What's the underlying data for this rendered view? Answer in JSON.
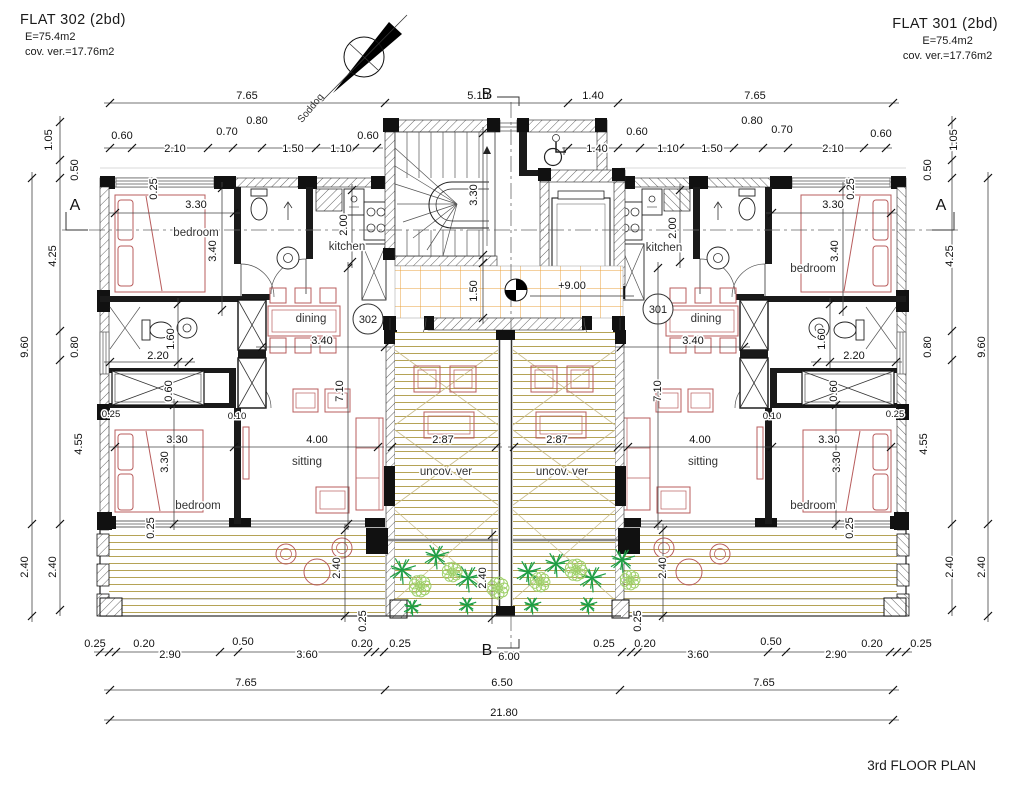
{
  "header": {
    "flat_left": {
      "title": "FLAT 302  (2bd)",
      "area": "E=75.4m2",
      "covered_veranda": "cov. ver.=17.76m2"
    },
    "flat_right": {
      "title": "FLAT 301  (2bd)",
      "area": "E=75.4m2",
      "covered_veranda": "cov. ver.=17.76m2"
    }
  },
  "footer": {
    "plan_title": "3rd FLOOR PLAN"
  },
  "north_arrow": {
    "label": "Soddog"
  },
  "level_marker": {
    "value": "+9.00"
  },
  "room_tags": [
    {
      "t": "302",
      "x": 368,
      "y": 323
    },
    {
      "t": "301",
      "x": 658,
      "y": 313
    }
  ],
  "colors": {
    "wall": "#111111",
    "dimension": "#444444",
    "furniture_red": "#b85c5c",
    "deck_tan": "#b5a356",
    "tile_orange": "#e8a23c",
    "plant_dark": "#1f9e45",
    "plant_light": "#9fd06a"
  },
  "dim_chains": [
    {
      "y": 103,
      "t": [
        110,
        385,
        568,
        618,
        893
      ]
    },
    {
      "y": 148,
      "t": [
        110,
        132,
        208,
        233,
        262,
        316,
        355,
        377
      ]
    },
    {
      "y": 148,
      "t": [
        568,
        618,
        640,
        680,
        734,
        763,
        788,
        864,
        886
      ]
    },
    {
      "y": 213,
      "t": [
        115,
        234
      ]
    },
    {
      "y": 213,
      "t": [
        772,
        891
      ]
    },
    {
      "y": 347,
      "t": [
        262,
        385
      ]
    },
    {
      "y": 347,
      "t": [
        621,
        744
      ]
    },
    {
      "y": 362,
      "t": [
        110,
        189
      ]
    },
    {
      "y": 362,
      "t": [
        817,
        896
      ]
    },
    {
      "y": 447,
      "t": [
        115,
        234,
        378
      ]
    },
    {
      "y": 447,
      "t": [
        392,
        496
      ]
    },
    {
      "y": 447,
      "t": [
        514,
        618
      ]
    },
    {
      "y": 447,
      "t": [
        628,
        772,
        891
      ]
    },
    {
      "y": 652,
      "t": [
        100,
        109,
        116,
        220,
        238,
        368,
        375,
        384,
        622,
        631,
        638,
        768,
        786,
        890,
        897,
        906
      ]
    },
    {
      "y": 690,
      "t": [
        110,
        385,
        620,
        893
      ]
    },
    {
      "y": 720,
      "t": [
        110,
        893
      ]
    },
    {
      "x": 32,
      "t": [
        178,
        524,
        616
      ]
    },
    {
      "x": 60,
      "t": [
        122,
        160,
        178,
        331,
        360,
        524,
        610
      ]
    },
    {
      "x": 988,
      "t": [
        178,
        524,
        616
      ]
    },
    {
      "x": 952,
      "t": [
        122,
        160,
        178,
        331,
        360,
        524,
        610
      ]
    },
    {
      "x": 222,
      "t": [
        188,
        310
      ]
    },
    {
      "x": 843,
      "t": [
        188,
        310
      ]
    },
    {
      "x": 352,
      "t": [
        190,
        262
      ]
    },
    {
      "x": 680,
      "t": [
        190,
        262
      ]
    },
    {
      "x": 174,
      "t": [
        405,
        524
      ]
    },
    {
      "x": 836,
      "t": [
        405,
        524
      ]
    },
    {
      "x": 348,
      "t": [
        268,
        524
      ]
    },
    {
      "x": 658,
      "t": [
        268,
        524
      ]
    },
    {
      "x": 483,
      "t": [
        133,
        255
      ]
    },
    {
      "x": 483,
      "t": [
        263,
        318
      ]
    },
    {
      "x": 345,
      "t": [
        530,
        616
      ]
    },
    {
      "x": 663,
      "t": [
        530,
        616
      ]
    },
    {
      "x": 492,
      "t": [
        535,
        618
      ]
    },
    {
      "x": 178,
      "t": [
        304,
        362
      ]
    },
    {
      "x": 830,
      "t": [
        304,
        362
      ]
    }
  ],
  "labels": [
    {
      "t": "7.65",
      "x": 247,
      "y": 99
    },
    {
      "t": "5.10",
      "x": 478,
      "y": 99
    },
    {
      "t": "1.40",
      "x": 593,
      "y": 99
    },
    {
      "t": "7.65",
      "x": 755,
      "y": 99
    },
    {
      "t": "0.60",
      "x": 122,
      "y": 139
    },
    {
      "t": "2.10",
      "x": 175,
      "y": 152
    },
    {
      "t": "0.70",
      "x": 227,
      "y": 135
    },
    {
      "t": "0.80",
      "x": 257,
      "y": 124
    },
    {
      "t": "1.50",
      "x": 293,
      "y": 152
    },
    {
      "t": "1.10",
      "x": 341,
      "y": 152
    },
    {
      "t": "0.60",
      "x": 368,
      "y": 139
    },
    {
      "t": "1.40",
      "x": 597,
      "y": 152
    },
    {
      "t": "0.60",
      "x": 637,
      "y": 135
    },
    {
      "t": "1.10",
      "x": 668,
      "y": 152
    },
    {
      "t": "1.50",
      "x": 712,
      "y": 152
    },
    {
      "t": "0.80",
      "x": 752,
      "y": 124
    },
    {
      "t": "0.70",
      "x": 782,
      "y": 133
    },
    {
      "t": "2.10",
      "x": 833,
      "y": 152
    },
    {
      "t": "0.60",
      "x": 881,
      "y": 137
    },
    {
      "t": "1.05",
      "x": 52,
      "y": 140,
      "r": -90
    },
    {
      "t": "0.50",
      "x": 78,
      "y": 170,
      "r": -90
    },
    {
      "t": "4.25",
      "x": 56,
      "y": 256,
      "r": -90
    },
    {
      "t": "0.80",
      "x": 78,
      "y": 347,
      "r": -90
    },
    {
      "t": "4.55",
      "x": 82,
      "y": 444,
      "r": -90
    },
    {
      "t": "2.40",
      "x": 56,
      "y": 567,
      "r": -90
    },
    {
      "t": "9.60",
      "x": 28,
      "y": 347,
      "r": -90
    },
    {
      "t": "2.40",
      "x": 28,
      "y": 567,
      "r": -90
    },
    {
      "t": "1.05",
      "x": 957,
      "y": 140,
      "r": -90
    },
    {
      "t": "0.50",
      "x": 931,
      "y": 170,
      "r": -90
    },
    {
      "t": "4.25",
      "x": 953,
      "y": 256,
      "r": -90
    },
    {
      "t": "0.80",
      "x": 931,
      "y": 347,
      "r": -90
    },
    {
      "t": "4.55",
      "x": 927,
      "y": 444,
      "r": -90
    },
    {
      "t": "2.40",
      "x": 953,
      "y": 567,
      "r": -90
    },
    {
      "t": "9.60",
      "x": 985,
      "y": 347,
      "r": -90
    },
    {
      "t": "2.40",
      "x": 985,
      "y": 567,
      "r": -90
    },
    {
      "t": "0.25",
      "x": 95,
      "y": 647
    },
    {
      "t": "0.20",
      "x": 144,
      "y": 647
    },
    {
      "t": "2.90",
      "x": 170,
      "y": 658
    },
    {
      "t": "0.50",
      "x": 243,
      "y": 645
    },
    {
      "t": "3.60",
      "x": 307,
      "y": 658
    },
    {
      "t": "0.20",
      "x": 362,
      "y": 647
    },
    {
      "t": "0.25",
      "x": 400,
      "y": 647
    },
    {
      "t": "6.00",
      "x": 509,
      "y": 660
    },
    {
      "t": "0.25",
      "x": 604,
      "y": 647
    },
    {
      "t": "0.20",
      "x": 645,
      "y": 647
    },
    {
      "t": "3.60",
      "x": 698,
      "y": 658
    },
    {
      "t": "0.50",
      "x": 771,
      "y": 645
    },
    {
      "t": "2.90",
      "x": 836,
      "y": 658
    },
    {
      "t": "0.20",
      "x": 872,
      "y": 647
    },
    {
      "t": "0.25",
      "x": 921,
      "y": 647
    },
    {
      "t": "7.65",
      "x": 246,
      "y": 686
    },
    {
      "t": "6.50",
      "x": 502,
      "y": 686
    },
    {
      "t": "7.65",
      "x": 764,
      "y": 686
    },
    {
      "t": "21.80",
      "x": 504,
      "y": 716
    },
    {
      "t": "0.25",
      "x": 157,
      "y": 189,
      "r": -90
    },
    {
      "t": "3.30",
      "x": 196,
      "y": 208
    },
    {
      "t": "3.40",
      "x": 216,
      "y": 251,
      "r": -90
    },
    {
      "t": "2.00",
      "x": 347,
      "y": 225,
      "r": -90
    },
    {
      "t": "3.40",
      "x": 322,
      "y": 344
    },
    {
      "t": "2.20",
      "x": 158,
      "y": 359
    },
    {
      "t": "1.60",
      "x": 174,
      "y": 339,
      "r": -90
    },
    {
      "t": "0.60",
      "x": 172,
      "y": 391,
      "r": -90
    },
    {
      "t": "0.25",
      "x": 111,
      "y": 417,
      "c": "dim-sm"
    },
    {
      "t": "0.10",
      "x": 237,
      "y": 419,
      "c": "dim-sm"
    },
    {
      "t": "3.30",
      "x": 177,
      "y": 443
    },
    {
      "t": "3.30",
      "x": 168,
      "y": 462,
      "r": -90
    },
    {
      "t": "4.00",
      "x": 317,
      "y": 443
    },
    {
      "t": "7.10",
      "x": 343,
      "y": 391,
      "r": -90
    },
    {
      "t": "0.25",
      "x": 154,
      "y": 528,
      "r": -90
    },
    {
      "t": "2.40",
      "x": 340,
      "y": 568,
      "r": -90
    },
    {
      "t": "3.30",
      "x": 477,
      "y": 195,
      "r": -90
    },
    {
      "t": "1.50",
      "x": 477,
      "y": 291,
      "r": -90
    },
    {
      "t": "2.87",
      "x": 443,
      "y": 443
    },
    {
      "t": "2.87",
      "x": 557,
      "y": 443
    },
    {
      "t": "2.40",
      "x": 486,
      "y": 578,
      "r": -90
    },
    {
      "t": "+9.00",
      "x": 572,
      "y": 289
    },
    {
      "t": "0.25",
      "x": 366,
      "y": 621,
      "r": -90
    },
    {
      "t": "0.25",
      "x": 641,
      "y": 621,
      "r": -90
    },
    {
      "t": "0.25",
      "x": 854,
      "y": 189,
      "r": -90
    },
    {
      "t": "3.30",
      "x": 833,
      "y": 208
    },
    {
      "t": "3.40",
      "x": 838,
      "y": 251,
      "r": -90
    },
    {
      "t": "2.00",
      "x": 676,
      "y": 228,
      "r": -90
    },
    {
      "t": "3.40",
      "x": 693,
      "y": 344
    },
    {
      "t": "2.20",
      "x": 854,
      "y": 359
    },
    {
      "t": "1.60",
      "x": 825,
      "y": 339,
      "r": -90
    },
    {
      "t": "0.60",
      "x": 837,
      "y": 391,
      "r": -90
    },
    {
      "t": "0.25",
      "x": 895,
      "y": 417,
      "c": "dim-sm"
    },
    {
      "t": "0.10",
      "x": 772,
      "y": 419,
      "c": "dim-sm"
    },
    {
      "t": "3.30",
      "x": 829,
      "y": 443
    },
    {
      "t": "3.30",
      "x": 840,
      "y": 462,
      "r": -90
    },
    {
      "t": "4.00",
      "x": 700,
      "y": 443
    },
    {
      "t": "7.10",
      "x": 661,
      "y": 391,
      "r": -90
    },
    {
      "t": "0.25",
      "x": 853,
      "y": 528,
      "r": -90
    },
    {
      "t": "2.40",
      "x": 666,
      "y": 568,
      "r": -90
    },
    {
      "t": "bedroom",
      "x": 196,
      "y": 236,
      "c": "room",
      "n": "room-label-bedroom"
    },
    {
      "t": "kitchen",
      "x": 347,
      "y": 250,
      "c": "room",
      "n": "room-label-kitchen"
    },
    {
      "t": "dining",
      "x": 311,
      "y": 322,
      "c": "room",
      "n": "room-label-dining"
    },
    {
      "t": "sitting",
      "x": 307,
      "y": 465,
      "c": "room",
      "n": "room-label-sitting"
    },
    {
      "t": "bedroom",
      "x": 198,
      "y": 509,
      "c": "room",
      "n": "room-label-bedroom"
    },
    {
      "t": "uncov. ver",
      "x": 446,
      "y": 475,
      "c": "room",
      "n": "room-label-uncovered-veranda"
    },
    {
      "t": "uncov. ver",
      "x": 562,
      "y": 475,
      "c": "room",
      "n": "room-label-uncovered-veranda"
    },
    {
      "t": "kitchen",
      "x": 664,
      "y": 251,
      "c": "room",
      "n": "room-label-kitchen"
    },
    {
      "t": "dining",
      "x": 706,
      "y": 322,
      "c": "room",
      "n": "room-label-dining"
    },
    {
      "t": "bedroom",
      "x": 813,
      "y": 272,
      "c": "room",
      "n": "room-label-bedroom"
    },
    {
      "t": "sitting",
      "x": 703,
      "y": 465,
      "c": "room",
      "n": "room-label-sitting"
    },
    {
      "t": "bedroom",
      "x": 813,
      "y": 509,
      "c": "room",
      "n": "room-label-bedroom"
    },
    {
      "t": "A",
      "x": 75,
      "y": 210,
      "c": "sec",
      "n": "section-marker-a"
    },
    {
      "t": "A",
      "x": 941,
      "y": 210,
      "c": "sec",
      "n": "section-marker-a"
    },
    {
      "t": "B",
      "x": 487,
      "y": 99,
      "c": "sec",
      "n": "section-marker-b"
    },
    {
      "t": "B",
      "x": 487,
      "y": 655,
      "c": "sec",
      "n": "section-marker-b"
    }
  ],
  "plants": {
    "dark": [
      [
        402,
        570,
        15
      ],
      [
        436,
        556,
        14
      ],
      [
        468,
        578,
        15
      ],
      [
        528,
        572,
        14
      ],
      [
        556,
        564,
        14
      ],
      [
        592,
        578,
        15
      ],
      [
        622,
        560,
        14
      ],
      [
        412,
        607,
        10
      ],
      [
        467,
        605,
        10
      ],
      [
        532,
        605,
        10
      ],
      [
        588,
        605,
        10
      ]
    ],
    "light": [
      [
        420,
        586,
        11
      ],
      [
        452,
        572,
        10
      ],
      [
        498,
        588,
        11
      ],
      [
        540,
        582,
        10
      ],
      [
        576,
        570,
        11
      ],
      [
        630,
        580,
        10
      ]
    ]
  }
}
